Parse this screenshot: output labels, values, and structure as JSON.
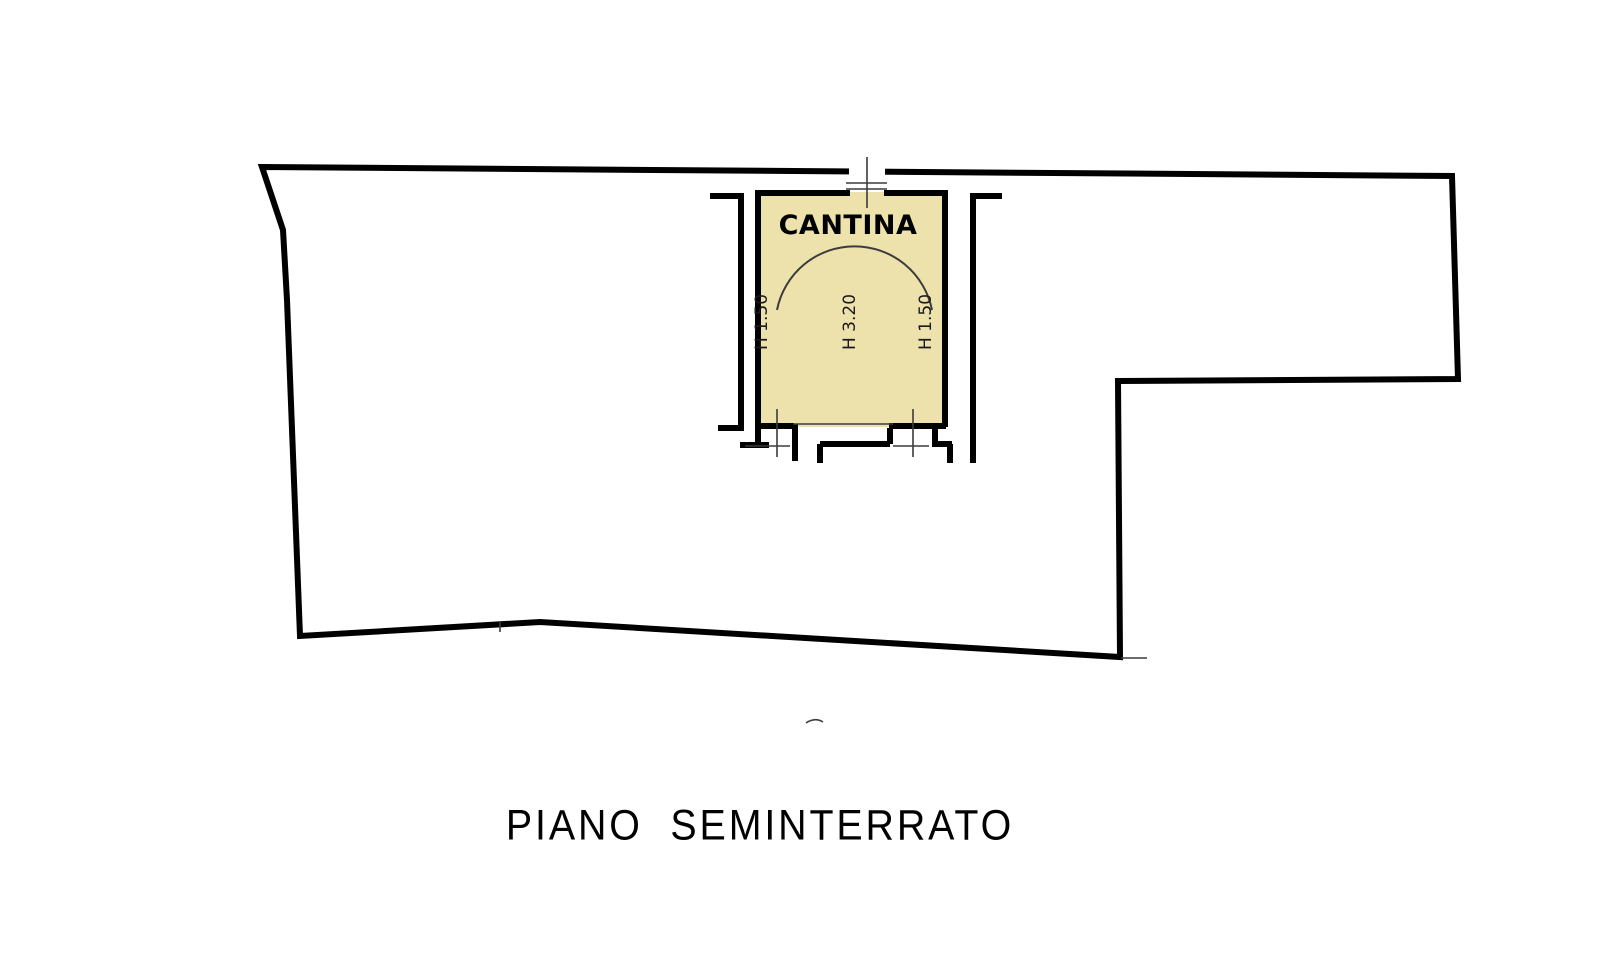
{
  "plan": {
    "floor_title": "PIANO  SEMINTERRATO",
    "room": {
      "name": "CANTINA",
      "fill_color": "#EDE2AC",
      "height_labels": {
        "left": "H 1.50",
        "center": "H 3.20",
        "right": "H 1.50"
      }
    },
    "colors": {
      "wall": "#000000",
      "thin_line": "#3c3c3c",
      "background": "#ffffff"
    }
  }
}
